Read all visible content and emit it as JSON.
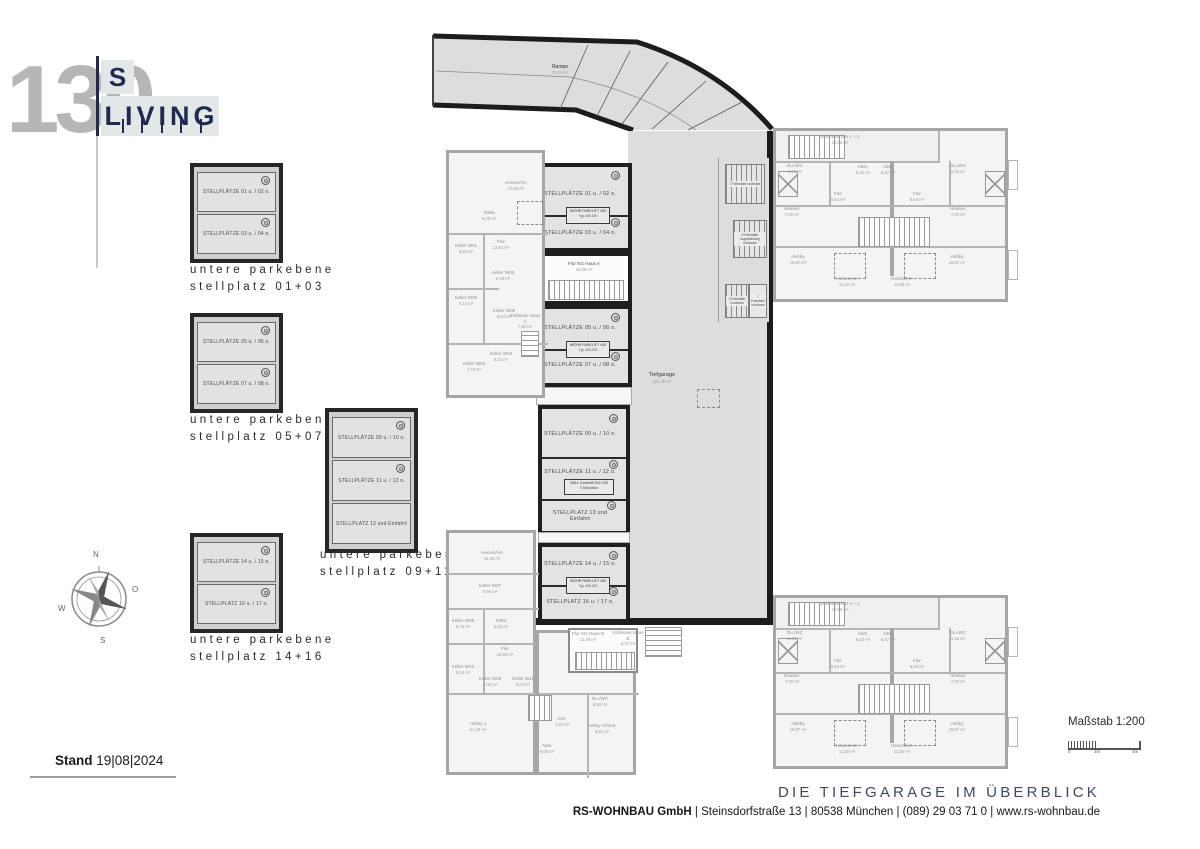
{
  "logo": {
    "number": "130",
    "top": "S",
    "bottom": "LIVING"
  },
  "colors": {
    "logo_navy": "#1e2a52",
    "logo_gray": "#b5b7b7",
    "wall_dark": "#1c1c1c",
    "garage_fill": "#dcdddd",
    "faded_wall": "#a6a6a6",
    "title_navy": "#3e4a63"
  },
  "detail_boxes": [
    {
      "stalls": [
        "STELLPLÄTZE 01 u. / 02 o.",
        "STELLPLÄTZE 03 u. / 04 o."
      ],
      "caption1": "untere parkebene",
      "caption2": "stellplatz 01+03"
    },
    {
      "stalls": [
        "STELLPLÄTZE 05 u. / 06 o.",
        "STELLPLÄTZE 07 u. / 08 o."
      ],
      "caption1": "untere parkebene",
      "caption2": "stellplatz 05+07"
    },
    {
      "stalls": [
        "STELLPLÄTZE 09 u. / 10 o.",
        "STELLPLÄTZE 11 u. / 12 o.",
        "STELLPLATZ 13 und Einfahrt"
      ],
      "caption1": "untere parkebene",
      "caption2": "stellplatz 09+11+13"
    },
    {
      "stalls": [
        "STELLPLÄTZE 14 u. / 15 o.",
        "STELLPLATZ 16 u. / 17 o."
      ],
      "caption1": "untere parkebene",
      "caption2": "stellplatz 14+16"
    }
  ],
  "compass": {
    "n": "N",
    "o": "O",
    "s": "S",
    "w": "W"
  },
  "plan": {
    "ramp": {
      "name": "Rampe",
      "area": "75,44 m²"
    },
    "garage": {
      "name": "Tiefgarage",
      "area": "421,36 m²"
    },
    "sections": [
      {
        "top": "STELLPLÄTZE 01 u. / 02 o.",
        "lift1": "WÖHR PARKLIFT 405",
        "lift2": "Typ 405-200",
        "bottom": "STELLPLÄTZE 03 u. / 04 o."
      },
      {
        "top": "STELLPLÄTZE 05 u. / 06 o.",
        "lift1": "WÖHR PARKLIFT 405",
        "lift2": "Typ 405-200",
        "bottom": "STELLPLÄTZE 07 u. / 08 o."
      },
      {
        "top": "STELLPLÄTZE 09 u. / 10 o.",
        "mid": "STELLPLÄTZE 11 u. / 12 o.",
        "lift1": "Wöhr Combilift 542-205",
        "lift2": "5 Stellplätze",
        "bottom": "STELLPLATZ 13 und Einfahrt"
      },
      {
        "top": "STELLPLÄTZE 14 u. / 15 o.",
        "lift1": "WÖHR PARKLIFT 405",
        "lift2": "Typ 405-200",
        "bottom": "STELLPLATZ 16 u. / 17 o."
      }
    ],
    "flur_haus_a": {
      "name": "Flur KG Haus A",
      "area": "18,55 m²"
    },
    "bike_racks": [
      "7 Fahrräder hochkant",
      "8 Fahrräder doppelstöckig hochkant",
      "3 Fahrräder hochkant",
      "7 Fahrräder hochkant"
    ],
    "left_upper_rooms": [
      {
        "name": "Heizen/HA",
        "area": "17,06 m²"
      },
      {
        "name": "KiWa",
        "area": "6,08 m²"
      },
      {
        "name": "Keller W01",
        "area": "5,53 m²"
      },
      {
        "name": "Flur",
        "area": "12,91 m²"
      },
      {
        "name": "Keller W06",
        "area": "6,46 m²"
      },
      {
        "name": "Keller W02",
        "area": "5,14 m²"
      },
      {
        "name": "Keller W05",
        "area": "5,04 m²"
      },
      {
        "name": "Schleuse Haus A",
        "area": "7,64 m²"
      },
      {
        "name": "Keller W04",
        "area": "6,32 m²"
      },
      {
        "name": "Keller W03",
        "area": "7,76 m²"
      }
    ],
    "left_lower_rooms": [
      {
        "name": "Heizen/HA",
        "area": "14,46 m²"
      },
      {
        "name": "Keller W07",
        "area": "6,65 m²"
      },
      {
        "name": "Keller W09",
        "area": "6,76 m²"
      },
      {
        "name": "KiWa",
        "area": "5,23 m²"
      },
      {
        "name": "Flur",
        "area": "15,90 m²"
      },
      {
        "name": "Keller W10",
        "area": "5,16 m²"
      },
      {
        "name": "Keller W08",
        "area": "5,06 m²"
      },
      {
        "name": "Keller W11",
        "area": "5,04 m²"
      },
      {
        "name": "Hobby 1",
        "area": "21,20 m²"
      },
      {
        "name": "Vorr.",
        "area": "7,20 m²"
      },
      {
        "name": "Abst.",
        "area": "6,05 m²"
      },
      {
        "name": "Du./WC",
        "area": "6,50 m²"
      },
      {
        "name": "Hobby 2/Abst.",
        "area": "8,81 m²"
      },
      {
        "name": "Flur KG Haus B",
        "area": "11,29 m²"
      },
      {
        "name": "Schleuse Haus B",
        "area": "6,37 m²"
      }
    ],
    "right_unit": {
      "du_wc": {
        "name": "Du./WC",
        "area": "5,28 m²"
      },
      "abst": {
        "name": "Abst.",
        "area": "5,42 m²"
      },
      "flur": {
        "name": "Flur",
        "area": "8,64 m²"
      },
      "hauswi": {
        "name": "Hauswi.",
        "area": "7,00 m²"
      },
      "hobby": {
        "name": "Hobby",
        "area": "18,87 m²"
      },
      "heizen": {
        "name": "Heizen/HA",
        "area": "11,56 m²"
      }
    },
    "right_upper_schleuse": {
      "name": "Schleuse WH 1 + 2",
      "area": "12,56 m²"
    },
    "right_lower_schleuse": {
      "name": "Schleuse WH 3 + 4",
      "area": "12,56 m²"
    }
  },
  "footer": {
    "stand_label": "Stand",
    "stand_date": "19|08|2024",
    "title": "DIE TIEFGARAGE IM ÜBERBLICK",
    "address_bold": "RS-WOHNBAU GmbH",
    "address_rest": " | Steinsdorfstraße 13 |  80538 München | (089) 29 03 71 0 | www.rs-wohnbau.de",
    "scale_label": "Maßstab 1:200",
    "scale_ticks": [
      "0",
      "2m",
      "4m"
    ]
  }
}
